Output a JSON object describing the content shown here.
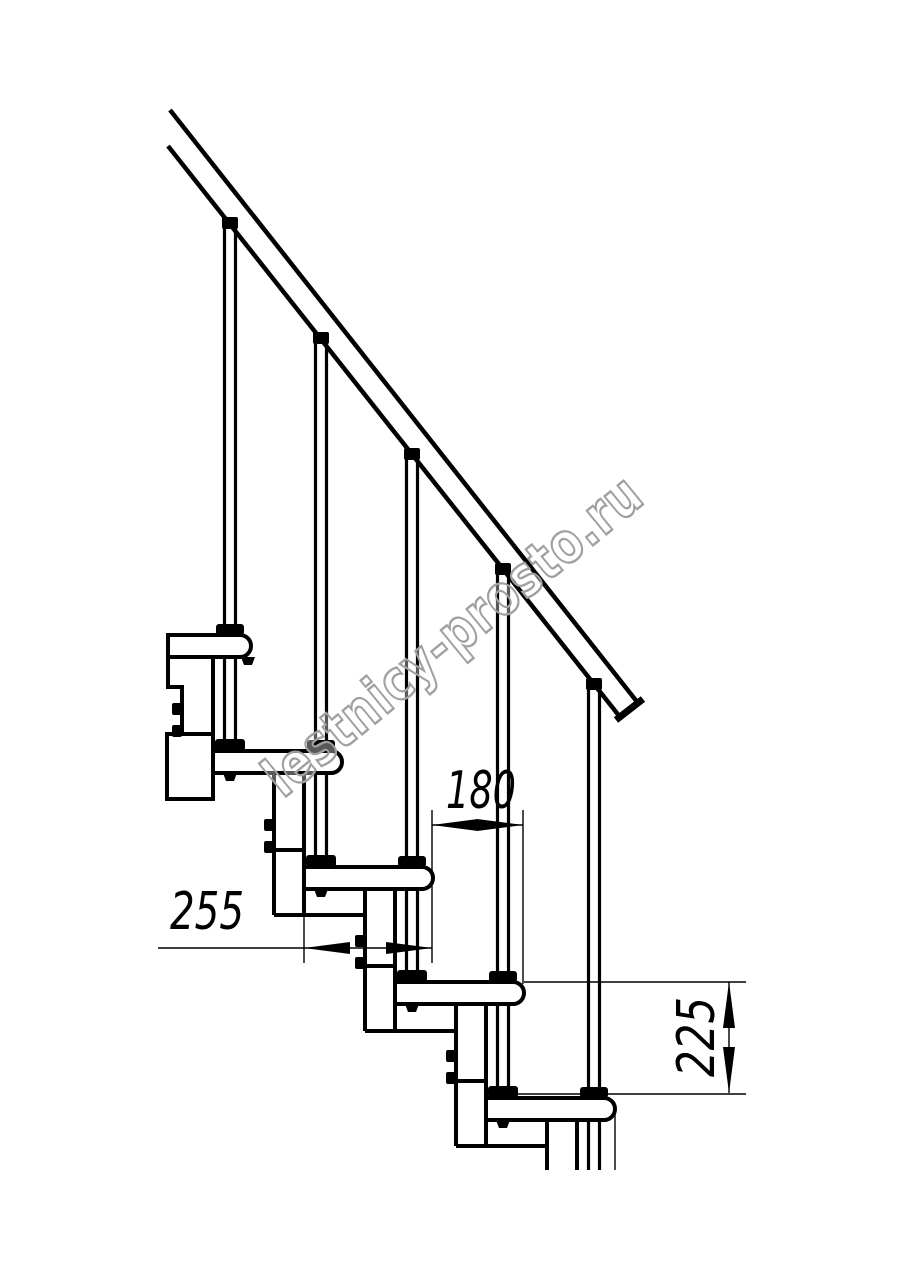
{
  "page": {
    "width": 914,
    "height": 1280,
    "background": "#ffffff"
  },
  "drawing": {
    "subject": "Modular staircase side elevation technical drawing",
    "line_color": "#000000",
    "tread_count": 5,
    "baluster_count": 5,
    "has_handrail": true
  },
  "watermark": {
    "text": "lestnicy-prosto.ru",
    "color": "#a0a0a0"
  },
  "dimensions": {
    "tread_depth": {
      "label": "255",
      "value": 255,
      "unit": "mm",
      "orientation": "horizontal",
      "measures": "tread depth"
    },
    "step_going": {
      "label": "180",
      "value": 180,
      "unit": "mm",
      "orientation": "horizontal",
      "measures": "step going between tread noses"
    },
    "step_rise": {
      "label": "225",
      "value": 225,
      "unit": "mm",
      "orientation": "vertical",
      "measures": "step rise between tread tops"
    }
  }
}
